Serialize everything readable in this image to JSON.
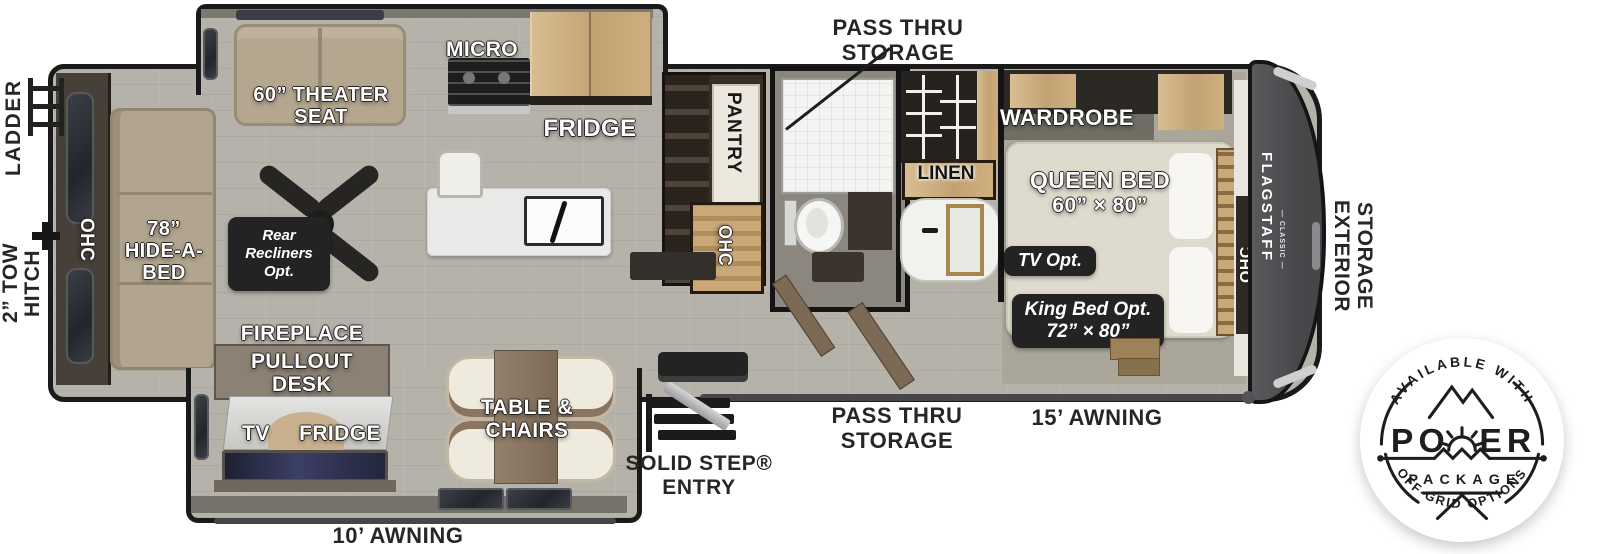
{
  "labels": {
    "ladder": "LADDER",
    "tow_hitch": "2” TOW HITCH",
    "pass_thru_storage_top": "PASS THRU STORAGE",
    "pass_thru_storage_bottom": "PASS THRU STORAGE",
    "awning_15": "15’ AWNING",
    "awning_10": "10’ AWNING",
    "solid_step_entry": "SOLID STEP® ENTRY",
    "exterior_storage": "EXTERIOR STORAGE"
  },
  "fixtures": {
    "ohc_rear": "OHC",
    "hide_a_bed": "78” HIDE-A-BED",
    "theater_seat": "60” THEATER SEAT",
    "micro": "MICRO",
    "fridge": "FRIDGE",
    "pantry": "PANTRY",
    "ohc_kitchen": "OHC",
    "linen": "LINEN",
    "wardrobe": "WARDROBE",
    "queen_bed": "QUEEN BED",
    "queen_bed_size": "60” × 80”",
    "ohc_bedroom": "OHC",
    "fireplace": "FIREPLACE",
    "pullout_desk": "PULLOUT DESK",
    "tv": "TV",
    "fridge_desk": "FRIDGE",
    "table_chairs": "TABLE & CHAIRS"
  },
  "options": {
    "rear_recliners": "Rear Recliners Opt.",
    "tv_opt": "TV Opt.",
    "king_bed": "King Bed Opt.",
    "king_bed_size": "72” × 80”"
  },
  "brand": {
    "model": "FLAGSTAFF",
    "series": "— CLASSIC —"
  },
  "badge": {
    "arc_top": "AVAILABLE WITH",
    "power_left": "PO",
    "power_right": "ER",
    "package": "PACKAGE",
    "arc_bottom": "OFF-GRID OPTIONS"
  },
  "colors": {
    "floor": "#b5b2aa",
    "wall": "#1a1a1a",
    "wood": "#cfae7f",
    "cabinet_dark": "#372f27",
    "sofa": "#b5a78f",
    "island": "#e9e9e7",
    "bed": "#dedacd",
    "front_cap": "#4b4b4e",
    "option_box": "#232323",
    "silver": "#cfcfd2"
  }
}
